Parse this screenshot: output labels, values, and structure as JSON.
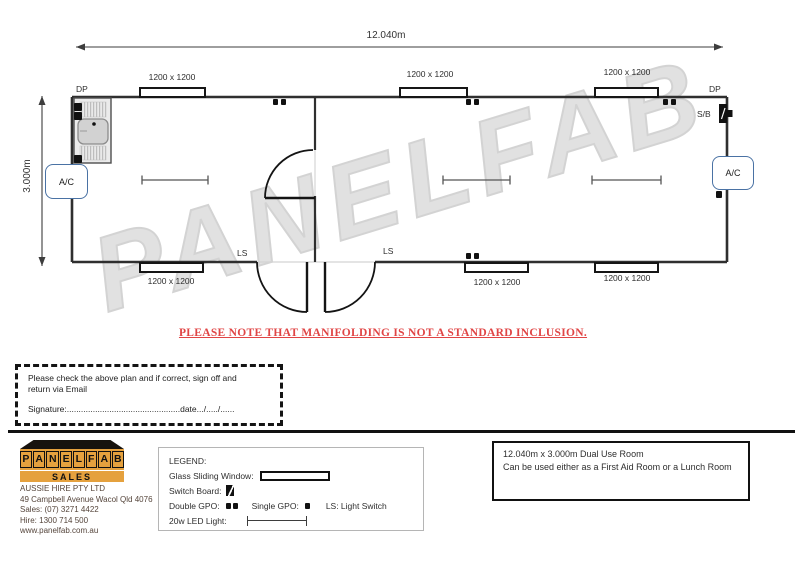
{
  "colors": {
    "brand_orange": "#E5A13E",
    "notice_red": "#E04545",
    "ac_border_blue": "#4A72A4",
    "watermark_gray": "#D2D2D2",
    "wall_black": "#2F2F2F"
  },
  "plan": {
    "total_width": "12.040m",
    "total_depth": "3.000m",
    "window_label": "1200 x 1200",
    "dp_label": "DP",
    "sb_label": "S/B",
    "ac_label": "A/C",
    "ls_label": "LS",
    "watermark": "PANELFAB"
  },
  "notice": "PLEASE NOTE THAT MANIFOLDING IS NOT A STANDARD INCLUSION.",
  "sign_off": {
    "line1": "Please check the above plan and if correct, sign off and",
    "line2": "return via Email",
    "signature_line": "Signature:................................................date.../...../......"
  },
  "footer": {
    "logo": {
      "letters": [
        "P",
        "A",
        "N",
        "E",
        "L",
        "F",
        "A",
        "B"
      ],
      "subtitle": "SALES"
    },
    "company": [
      "AUSSIE HIRE PTY LTD",
      "49 Campbell Avenue Wacol Qld 4076",
      "Sales: (07) 3271 4422",
      "Hire: 1300 714 500",
      "www.panelfab.com.au"
    ],
    "legend": {
      "title": "LEGEND:",
      "glass_sliding_window": "Glass Sliding Window:",
      "switch_board": "Switch Board:",
      "double_gpo": "Double GPO:",
      "single_gpo": "Single GPO:",
      "light_switch": "LS: Light Switch",
      "led_light": "20w LED Light:"
    },
    "info_box": [
      "12.040m x 3.000m Dual Use Room",
      "Can be used either as a First Aid Room or a Lunch Room"
    ]
  }
}
